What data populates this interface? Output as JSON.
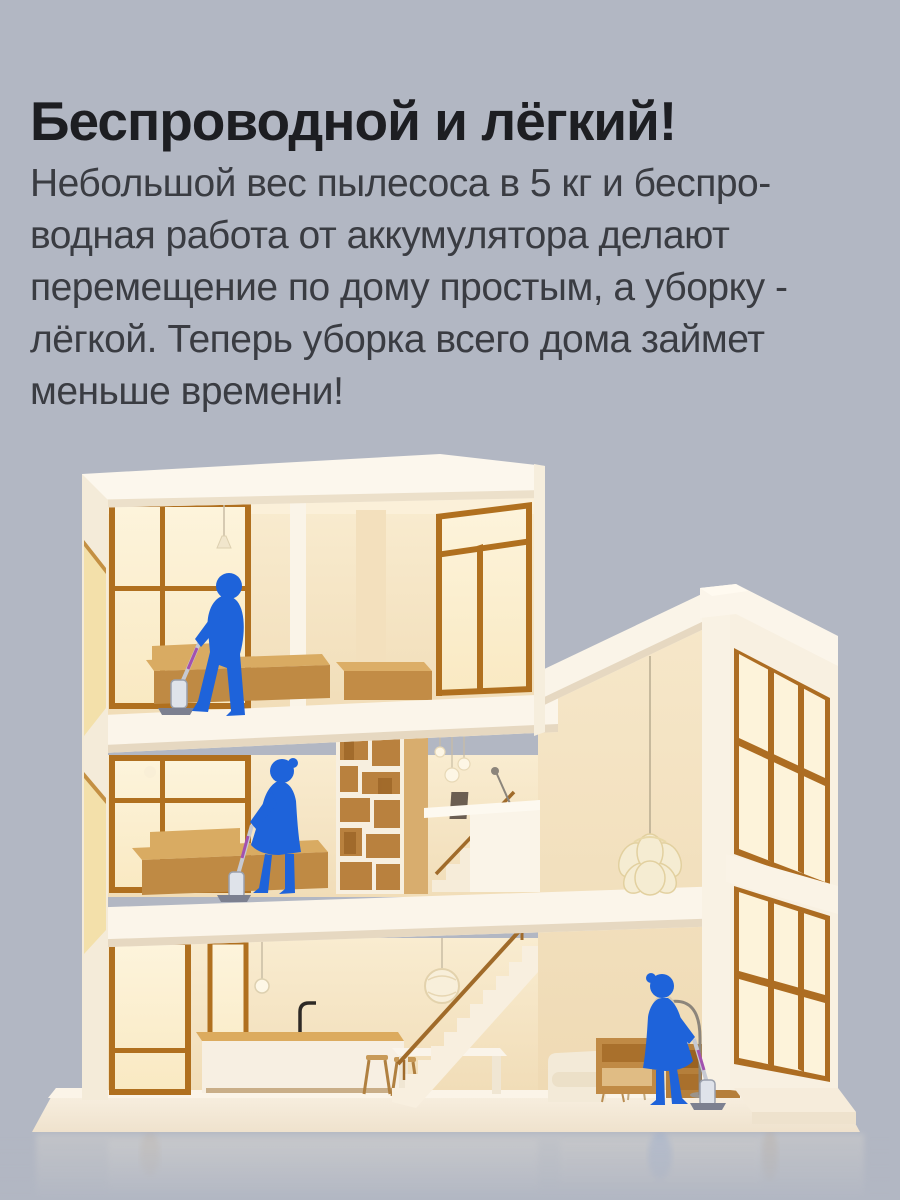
{
  "header": {
    "title": "Беспроводной и лёгкий!"
  },
  "description": {
    "lines": [
      "Небольшой вес пылесоса в 5 кг и беспро-",
      "водная работа от аккумулятора делают",
      "перемещение по дому простым, а уборку -",
      "лёгкой. Теперь уборка всего дома займет",
      "меньше времени!"
    ]
  },
  "illustration": {
    "description": "Трёхэтажный дом в разрезе: три человека убирают беспроводным пылесосом на каждом этаже",
    "figures": [
      "man-vacuuming-top-floor",
      "woman-vacuuming-second-floor",
      "woman-vacuuming-ground-floor"
    ],
    "colors": {
      "background": "#b2b7c3",
      "heading_text": "#1d1e22",
      "body_text": "#3a3c42",
      "figure_blue": "#1e63da",
      "house_cream": "#faf4e8",
      "interior_warm": "#f6e6c6",
      "wood_frame": "#b0701f",
      "wood_furniture": "#c89254",
      "vacuum_accent": "#a351af",
      "vacuum_body": "#d9dde4"
    }
  }
}
